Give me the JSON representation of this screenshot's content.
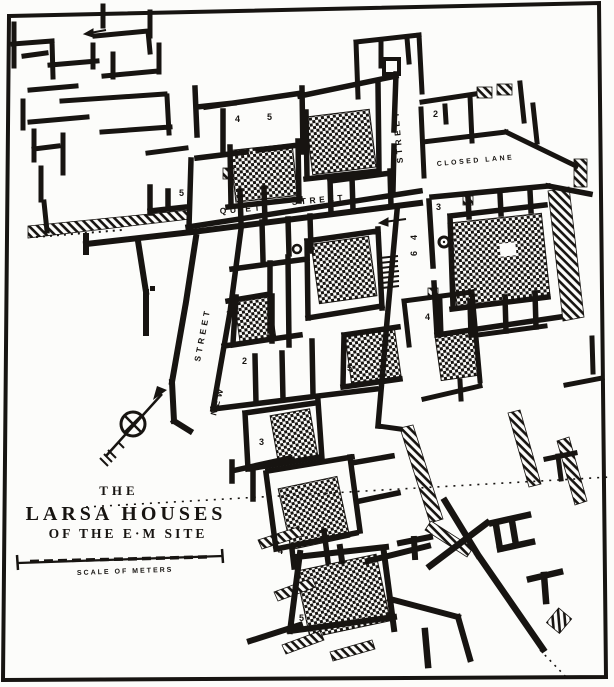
{
  "figure": {
    "title": {
      "line1": "THE",
      "line2": "LARSA  HOUSES",
      "line3": "OF THE E·M SITE"
    },
    "scale": {
      "label": "SCALE OF METERS"
    },
    "streets": {
      "quiet_word1": "QUIET",
      "quiet_word2": "STREET",
      "vertical": "STREET",
      "new_word1": "NEW",
      "new_word2": "STREET",
      "closed_lane": "CLOSED  LANE"
    },
    "house_numbers": [
      {
        "n": "4"
      },
      {
        "n": "5"
      },
      {
        "n": "3"
      },
      {
        "n": "5"
      },
      {
        "n": "2"
      },
      {
        "n": "3"
      },
      {
        "n": "1"
      },
      {
        "n": "2"
      },
      {
        "n": "5"
      },
      {
        "n": "4"
      },
      {
        "n": "3"
      },
      {
        "n": "4"
      },
      {
        "n": "5"
      },
      {
        "n": "4"
      },
      {
        "n": "6"
      }
    ],
    "colors": {
      "ink": "#171411",
      "paper": "#fcfcfa"
    }
  }
}
